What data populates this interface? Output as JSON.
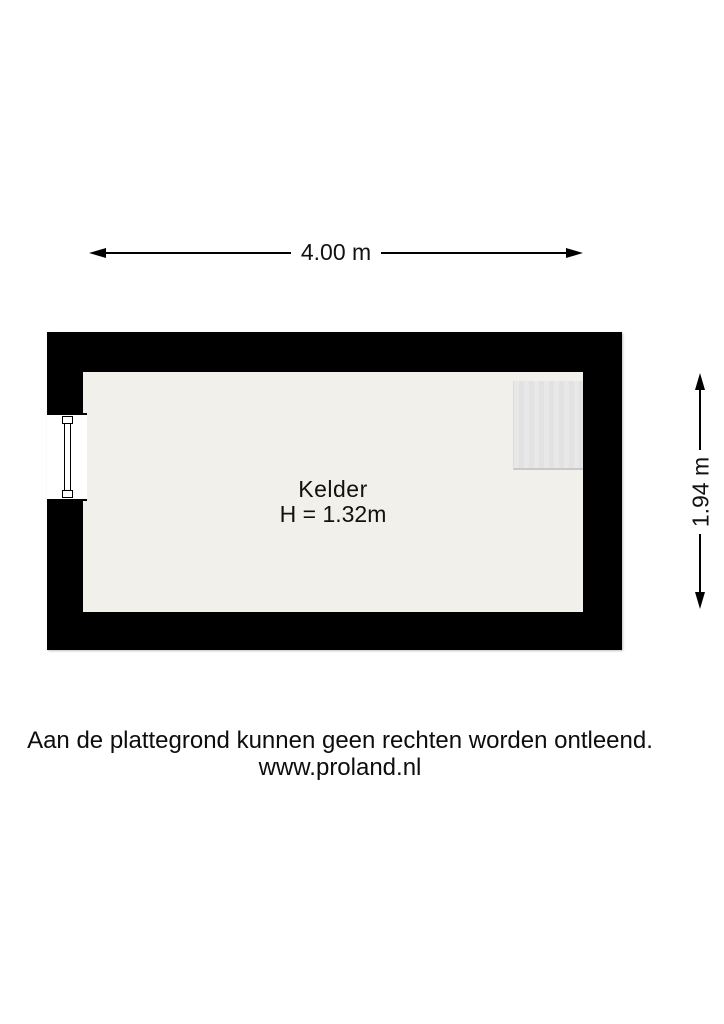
{
  "floorplan": {
    "room": {
      "name": "Kelder",
      "ceiling_height_label": "H = 1.32m"
    },
    "dimensions": {
      "width_label": "4.00 m",
      "height_label": "1.94 m"
    },
    "footer": {
      "disclaimer": "Aan de plattegrond kunnen geen rechten worden ontleend.",
      "website": "www.proland.nl"
    },
    "colors": {
      "wall": "#000000",
      "floor": "#f1f0ea",
      "stairs_block": "#e4e4e4",
      "background": "#ffffff",
      "text": "#111111"
    }
  }
}
